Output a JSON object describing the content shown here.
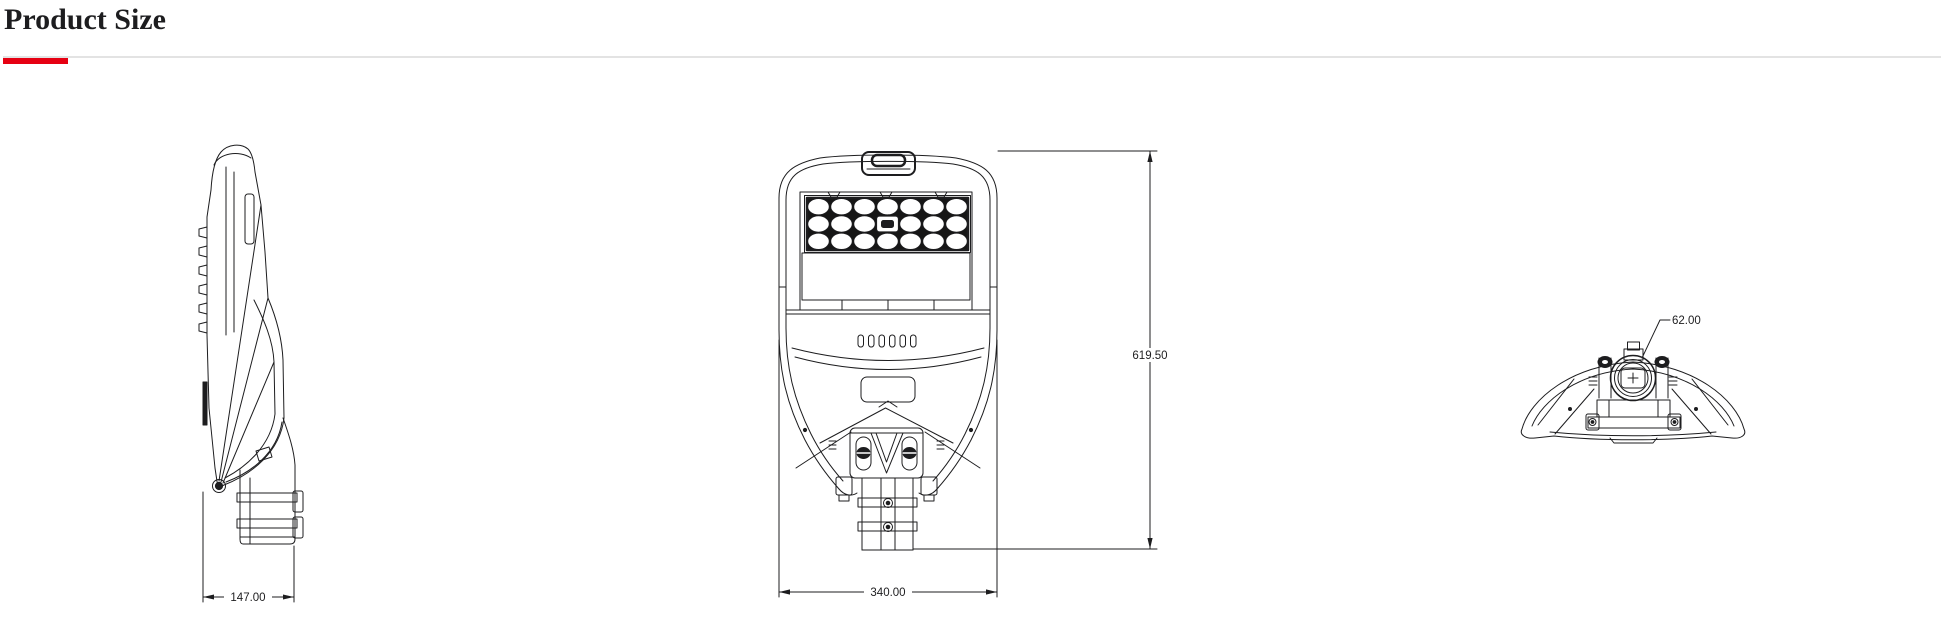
{
  "page": {
    "title": "Product Size"
  },
  "theme": {
    "accent_red": "#e60012",
    "divider_gray": "#e3e3e3",
    "ink": "#1d1d1f",
    "background": "#ffffff"
  },
  "drawings": {
    "side_view": {
      "overall_depth": "147.00"
    },
    "front_view": {
      "overall_width": "340.00",
      "overall_height": "619.50"
    },
    "rear_view": {
      "spigot_diameter": "62.00"
    }
  }
}
